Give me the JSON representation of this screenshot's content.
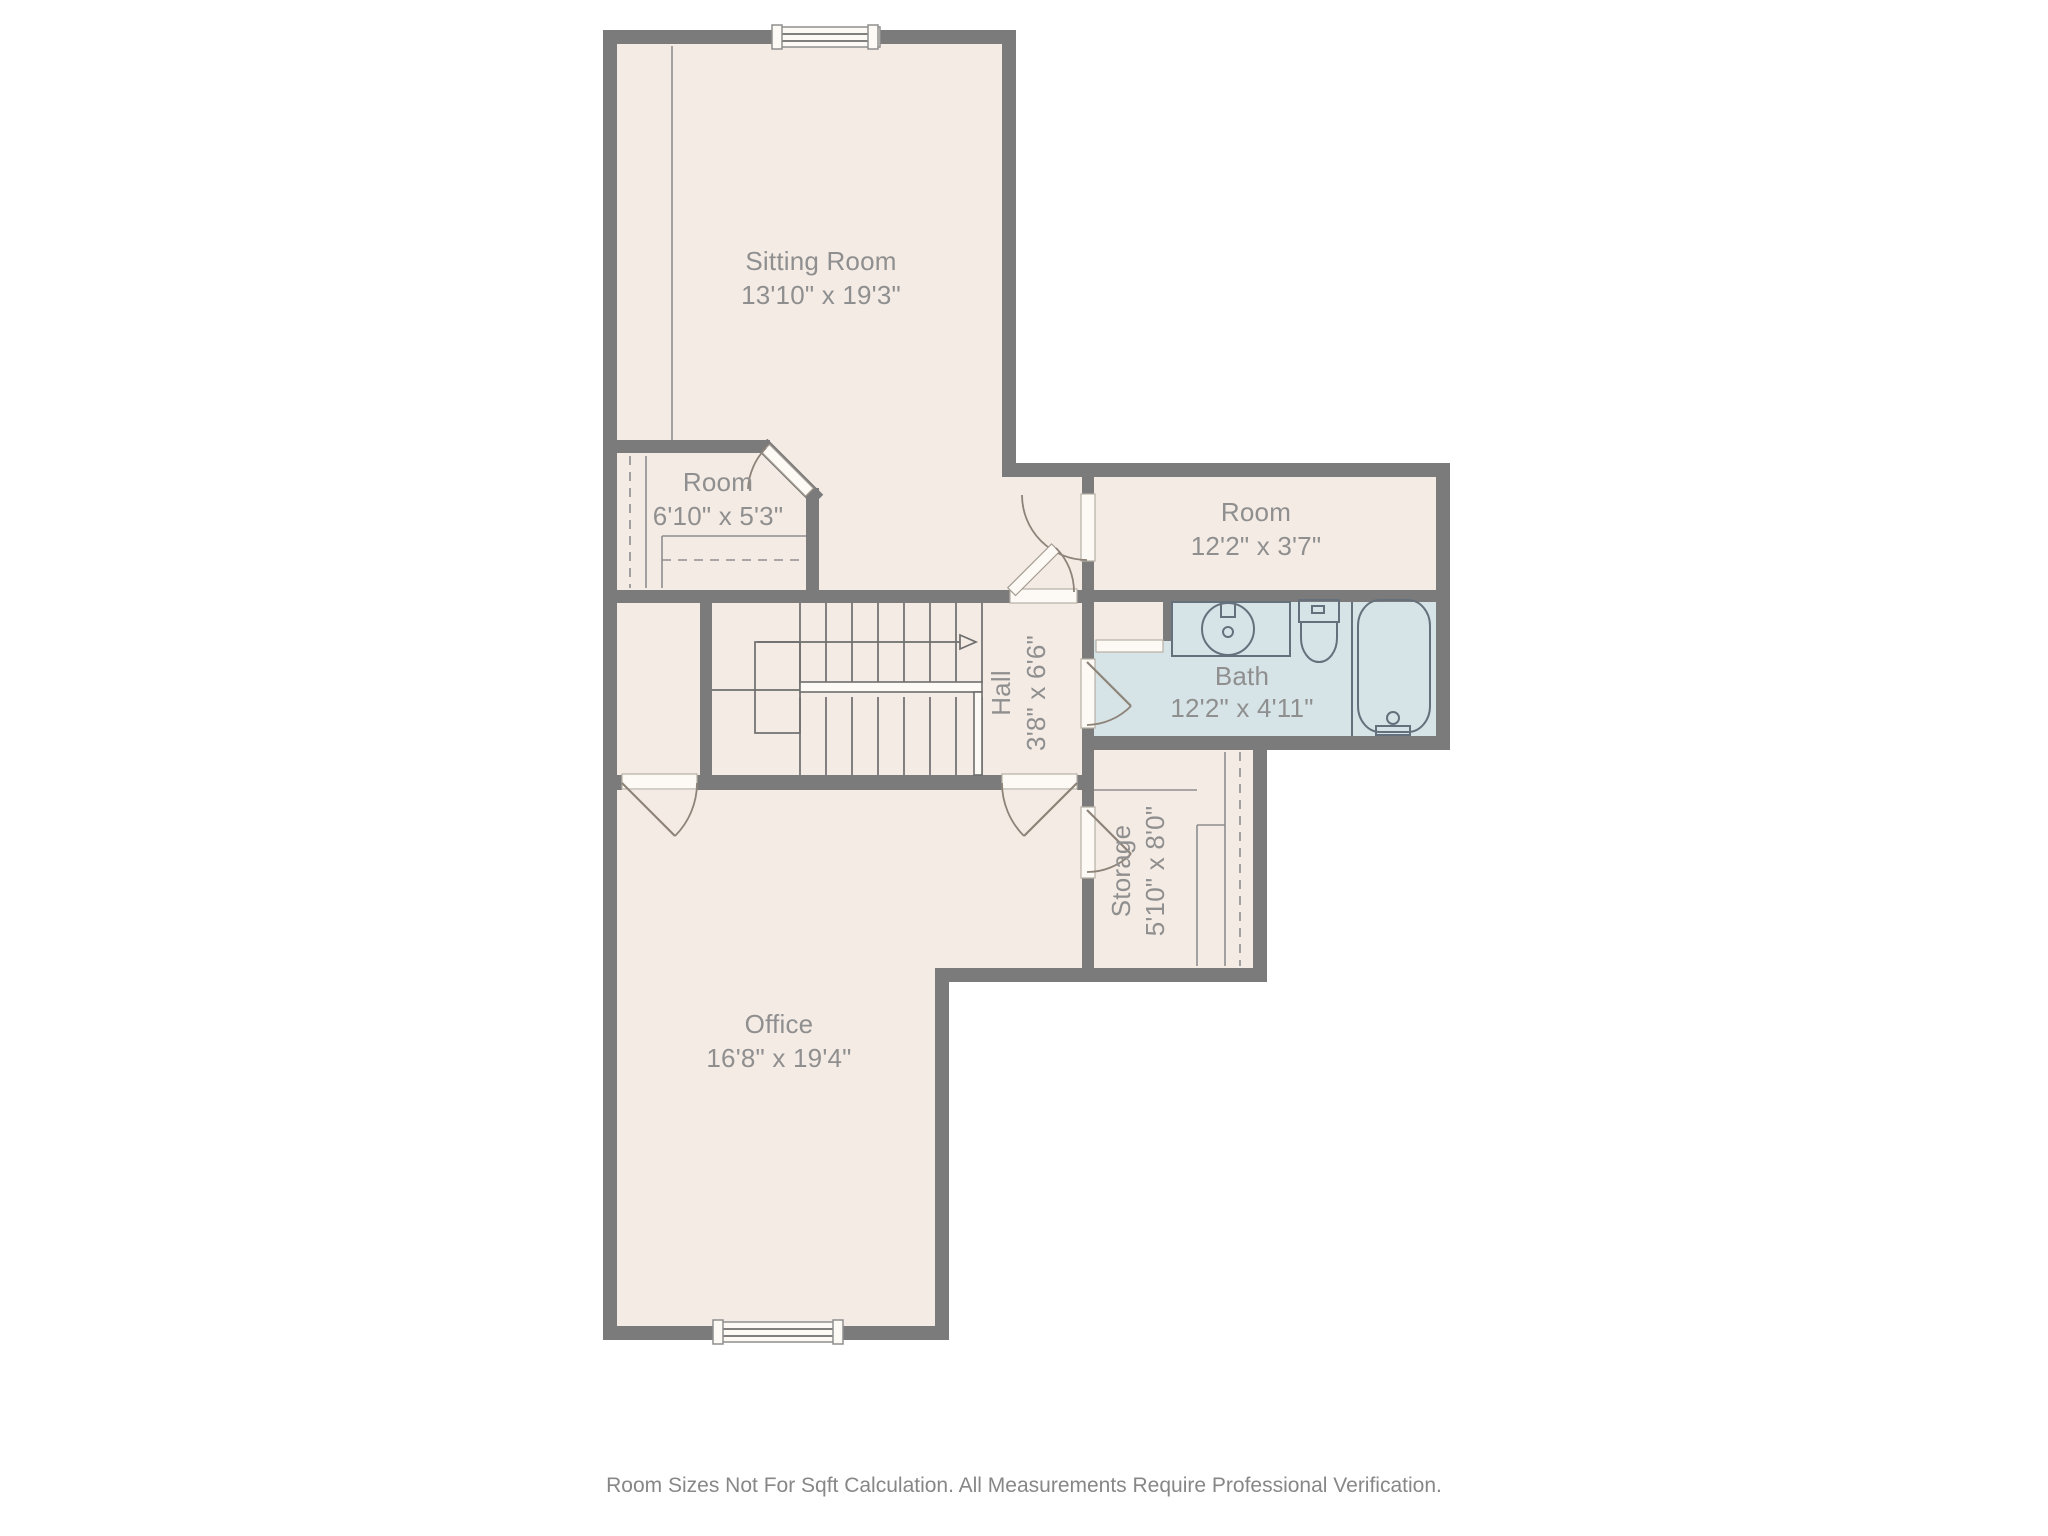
{
  "title": "Floor plan",
  "rooms": {
    "sitting": {
      "name": "Sitting Room",
      "dims": "13'10\" x 19'3\""
    },
    "small_room": {
      "name": "Room",
      "dims": "6'10\" x 5'3\""
    },
    "right_room": {
      "name": "Room",
      "dims": "12'2\" x 3'7\""
    },
    "hall": {
      "name": "Hall",
      "dims": "3'8\" x 6'6\""
    },
    "bath": {
      "name": "Bath",
      "dims": "12'2\" x 4'11\""
    },
    "storage": {
      "name": "Storage",
      "dims": "5'10\" x 8'0\""
    },
    "office": {
      "name": "Office",
      "dims": "16'8\" x 19'4\""
    }
  },
  "footer": {
    "disclaimer": "Room Sizes Not For Sqft Calculation. All Measurements Require Professional Verification."
  },
  "colors": {
    "wall": "#7b7b7b",
    "floor": "#f4ebe5",
    "bath": "#d7e4e7",
    "threshold": "#fdfaf6",
    "fixline": "#64717c",
    "doorline": "#8d8378",
    "stair": "#6e6e6e",
    "labeltext": "#8f8f8f",
    "footertext": "#878787"
  }
}
